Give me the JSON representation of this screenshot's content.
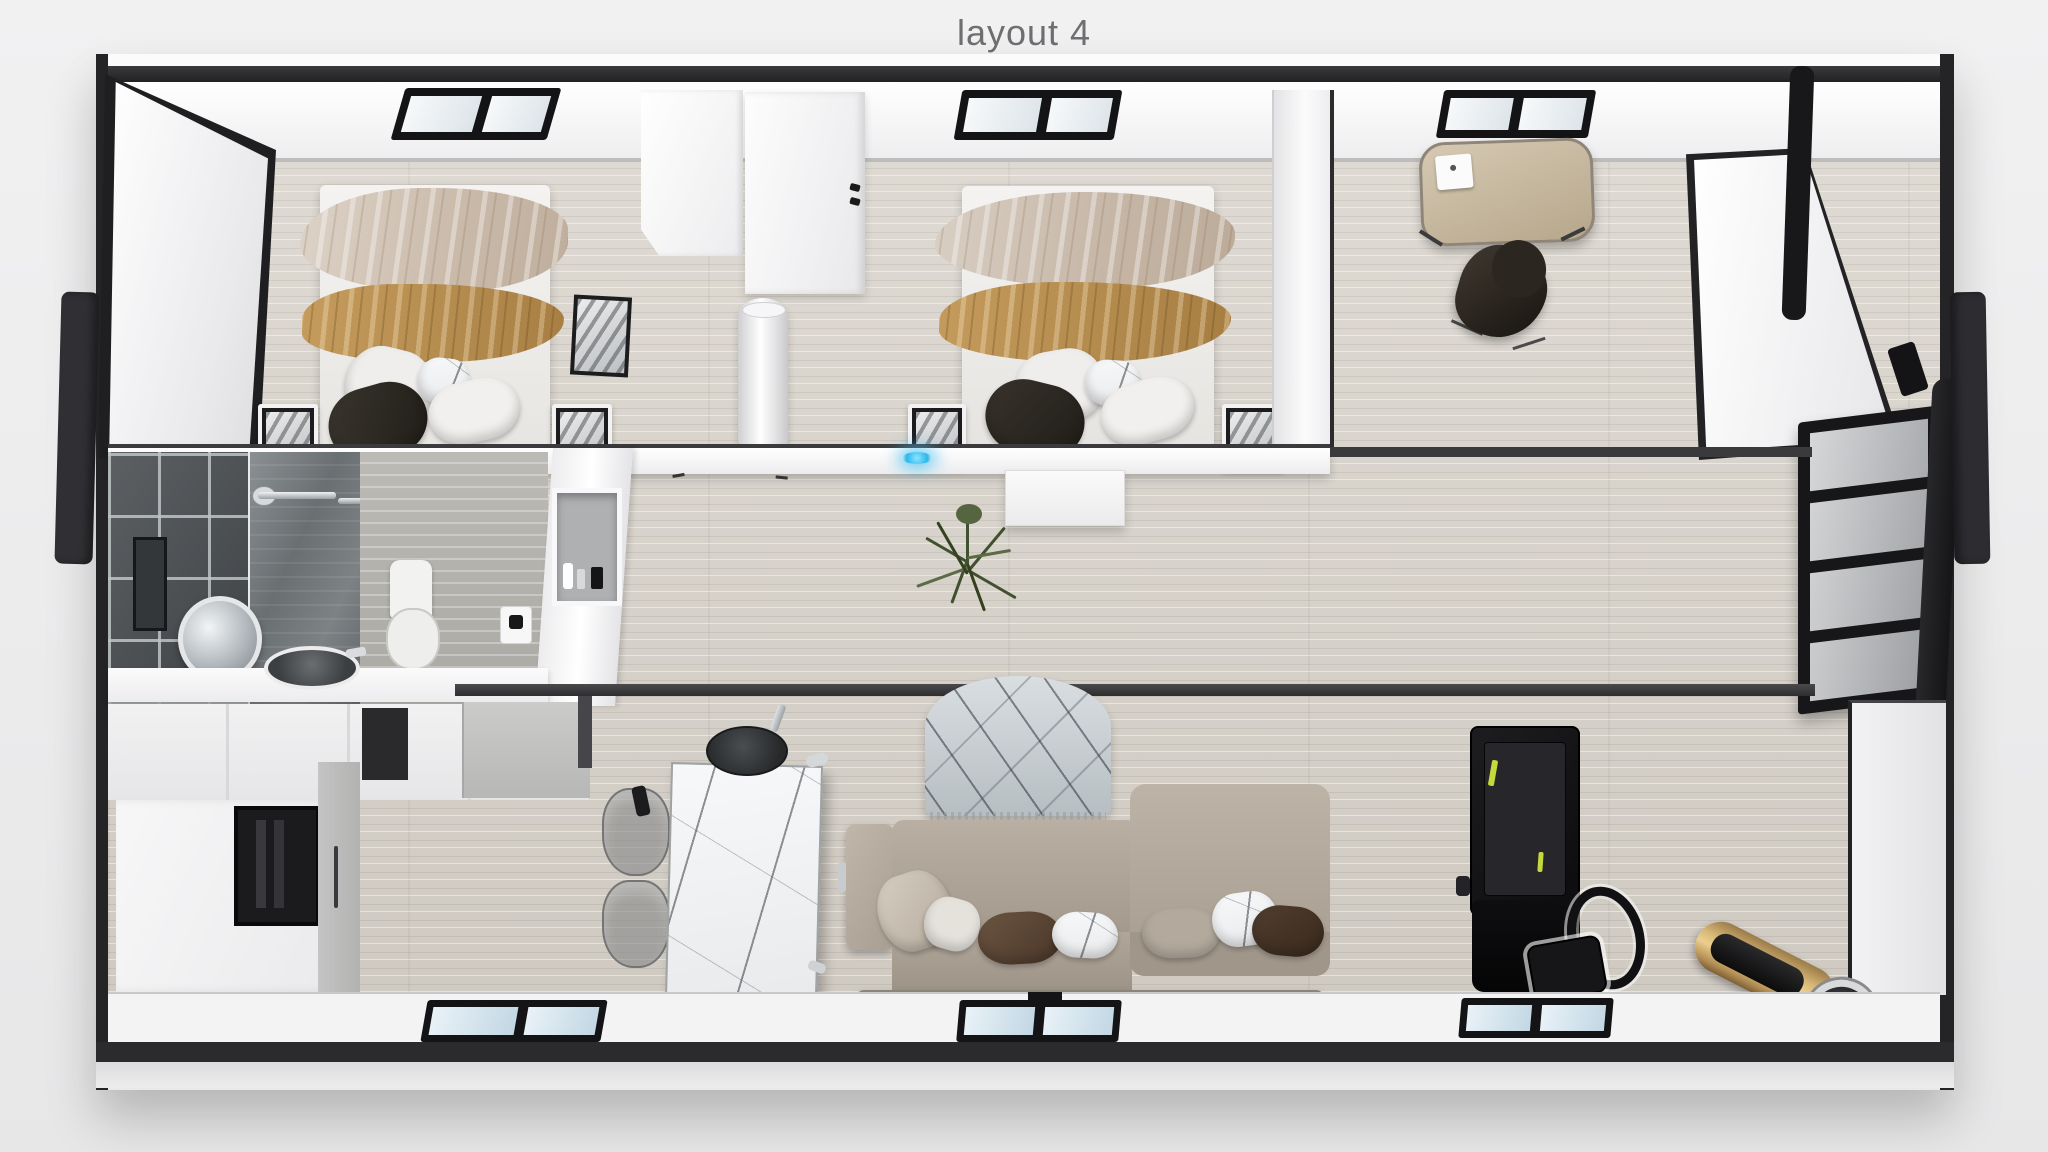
{
  "title": "layout 4",
  "palette": {
    "background": "#ededee",
    "frame_dark": "#2b2b2d",
    "wall_white": "#f6f6f7",
    "floor_wood": "#d7d3cc",
    "bathroom_tile": "#4c5053",
    "bedding_cream": "#d0c3b3",
    "bedding_gold": "#bb9455",
    "headboard_brown": "#5d4233",
    "sofa_taupe": "#b0a69a",
    "island_marble": "#f4f5f6",
    "treadmill_black": "#141416",
    "treadmill_accent": "#c6d93c",
    "roller_gold": "#d9b877",
    "plant_green": "#41502f",
    "accent_led_blue": "#3ec6f0",
    "window_glass_blue": "#c2d7e4"
  },
  "scene": {
    "rooms": [
      {
        "name": "bedroom-1",
        "items": [
          "double-bed",
          "cream-blanket",
          "gold-blanket",
          "pillows",
          "nightstand-left",
          "nightstand-right",
          "window"
        ]
      },
      {
        "name": "closet-nook",
        "items": [
          "wardrobe-a",
          "wardrobe-b",
          "tall-white-vase"
        ]
      },
      {
        "name": "bedroom-2",
        "items": [
          "double-bed",
          "cream-blanket",
          "gold-blanket",
          "pillows",
          "nightstand-left",
          "nightstand-right",
          "window"
        ]
      },
      {
        "name": "office",
        "items": [
          "desk",
          "laptop",
          "office-chair",
          "window"
        ]
      },
      {
        "name": "bathroom",
        "items": [
          "dark-tile-wall",
          "shower-glass",
          "shower-fixtures",
          "toilet",
          "vanity-counter",
          "vessel-sink",
          "round-mirror",
          "thermostat",
          "wall-niche-shelf"
        ]
      },
      {
        "name": "kitchen",
        "items": [
          "cabinet-row",
          "gray-cabinet",
          "storage-unit",
          "fireplace-niche",
          "marble-island",
          "cooking-pot",
          "faucet",
          "bar-stool",
          "bar-stool",
          "kettle"
        ]
      },
      {
        "name": "living-area",
        "items": [
          "marble-rug",
          "sectional-sofa",
          "cushions",
          "treadmill",
          "gold-roller-mat"
        ]
      },
      {
        "name": "entry",
        "items": [
          "open-glass-door",
          "door-posts"
        ]
      }
    ],
    "window_count_top": 3,
    "window_count_bottom": 3
  }
}
